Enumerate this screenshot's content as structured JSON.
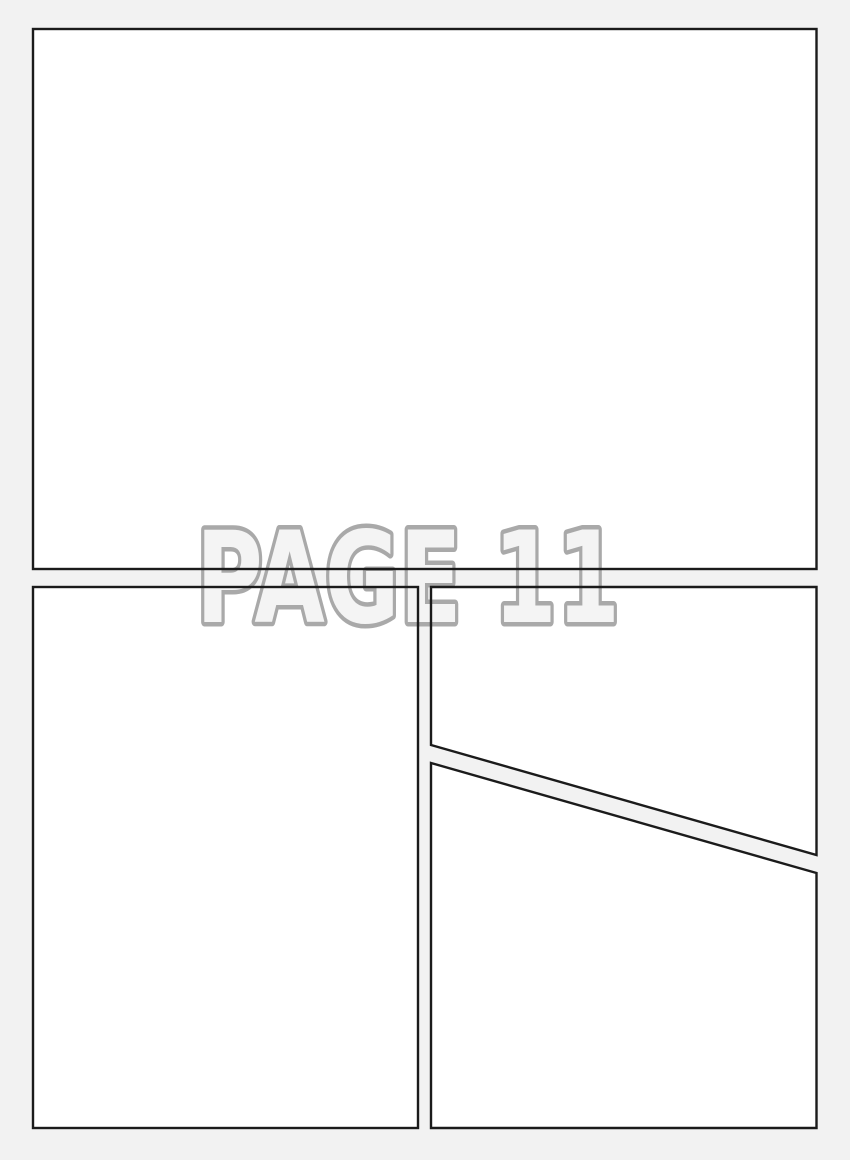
{
  "title": "PAGE 11",
  "page_number": "11",
  "colors": {
    "background": "#f2f2f2",
    "panel_fill": "#ffffff",
    "panel_border": "#1b1b1b",
    "title_fill": "#f4f4f4",
    "title_outline": "#a9a9a9"
  },
  "panels": [
    {
      "name": "top-panel"
    },
    {
      "name": "bottom-left-panel"
    },
    {
      "name": "bottom-right-upper-panel"
    },
    {
      "name": "bottom-right-lower-panel"
    }
  ]
}
